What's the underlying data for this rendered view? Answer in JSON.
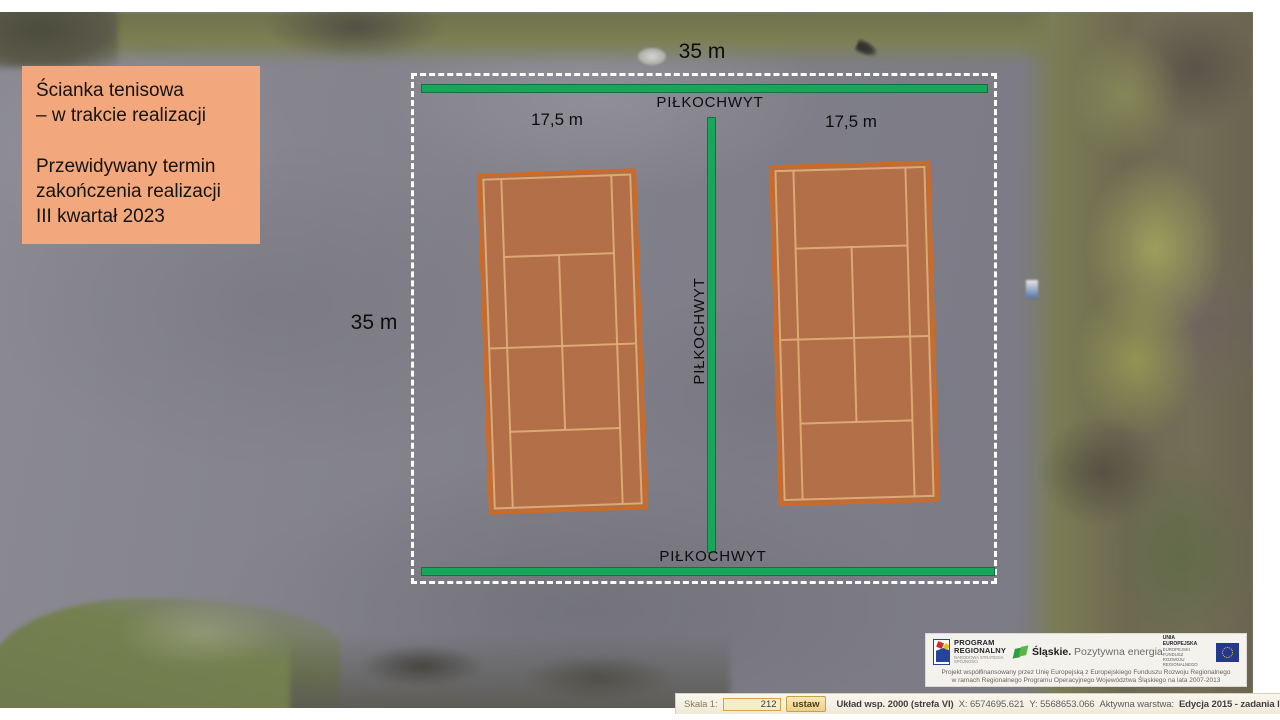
{
  "info_box": {
    "lines": [
      "Ścianka tenisowa",
      "– w trakcie realizacji",
      "",
      "Przewidywany termin",
      "zakończenia realizacji",
      "III kwartał 2023"
    ]
  },
  "plan": {
    "width_label_top": "35 m",
    "height_label_left": "35 m",
    "court_width_label_left": "17,5 m",
    "court_width_label_right": "17,5 m",
    "ballstop_label_top": "PIŁKOCHWYT",
    "ballstop_label_middle": "PIŁKOCHWYT",
    "ballstop_label_bottom": "PIŁKOCHWYT",
    "colors": {
      "ballstop_green": "#18a75a",
      "outline_dash_white": "#ffffff",
      "court_fill": "#b26f48",
      "court_border": "#d06a22",
      "court_lines": "#deac76",
      "info_box_bg": "#f2a77c"
    }
  },
  "funding_banner": {
    "program_regionalny": {
      "title_line1": "PROGRAM",
      "title_line2": "REGIONALNY",
      "subtitle": "NARODOWA STRATEGIA SPÓJNOŚCI"
    },
    "slaskie": {
      "brand": "Śląskie.",
      "tagline": " Pozytywna energia"
    },
    "eu": {
      "line1": "UNIA EUROPEJSKA",
      "line2": "EUROPEJSKI FUNDUSZ",
      "line3": "ROZWOJU REGIONALNEGO"
    },
    "footnote_line1": "Projekt współfinansowany przez Unię Europejską z Europejskiego Funduszu Rozwoju Regionalnego",
    "footnote_line2": "w ramach Regionalnego Programu Operacyjnego Województwa Śląskiego na lata 2007-2013"
  },
  "status_bar": {
    "scale_label": "Skala 1:",
    "scale_value": "212",
    "set_button_label": "ustaw",
    "crs_text": "Układ wsp. 2000 (strefa VI)",
    "x_text": "X: 6574695.621",
    "y_text": "Y: 5568653.066",
    "active_layer_label": "Aktywna warstwa:",
    "active_layer_value": "Edycja 2015 - zadania lokaln"
  }
}
